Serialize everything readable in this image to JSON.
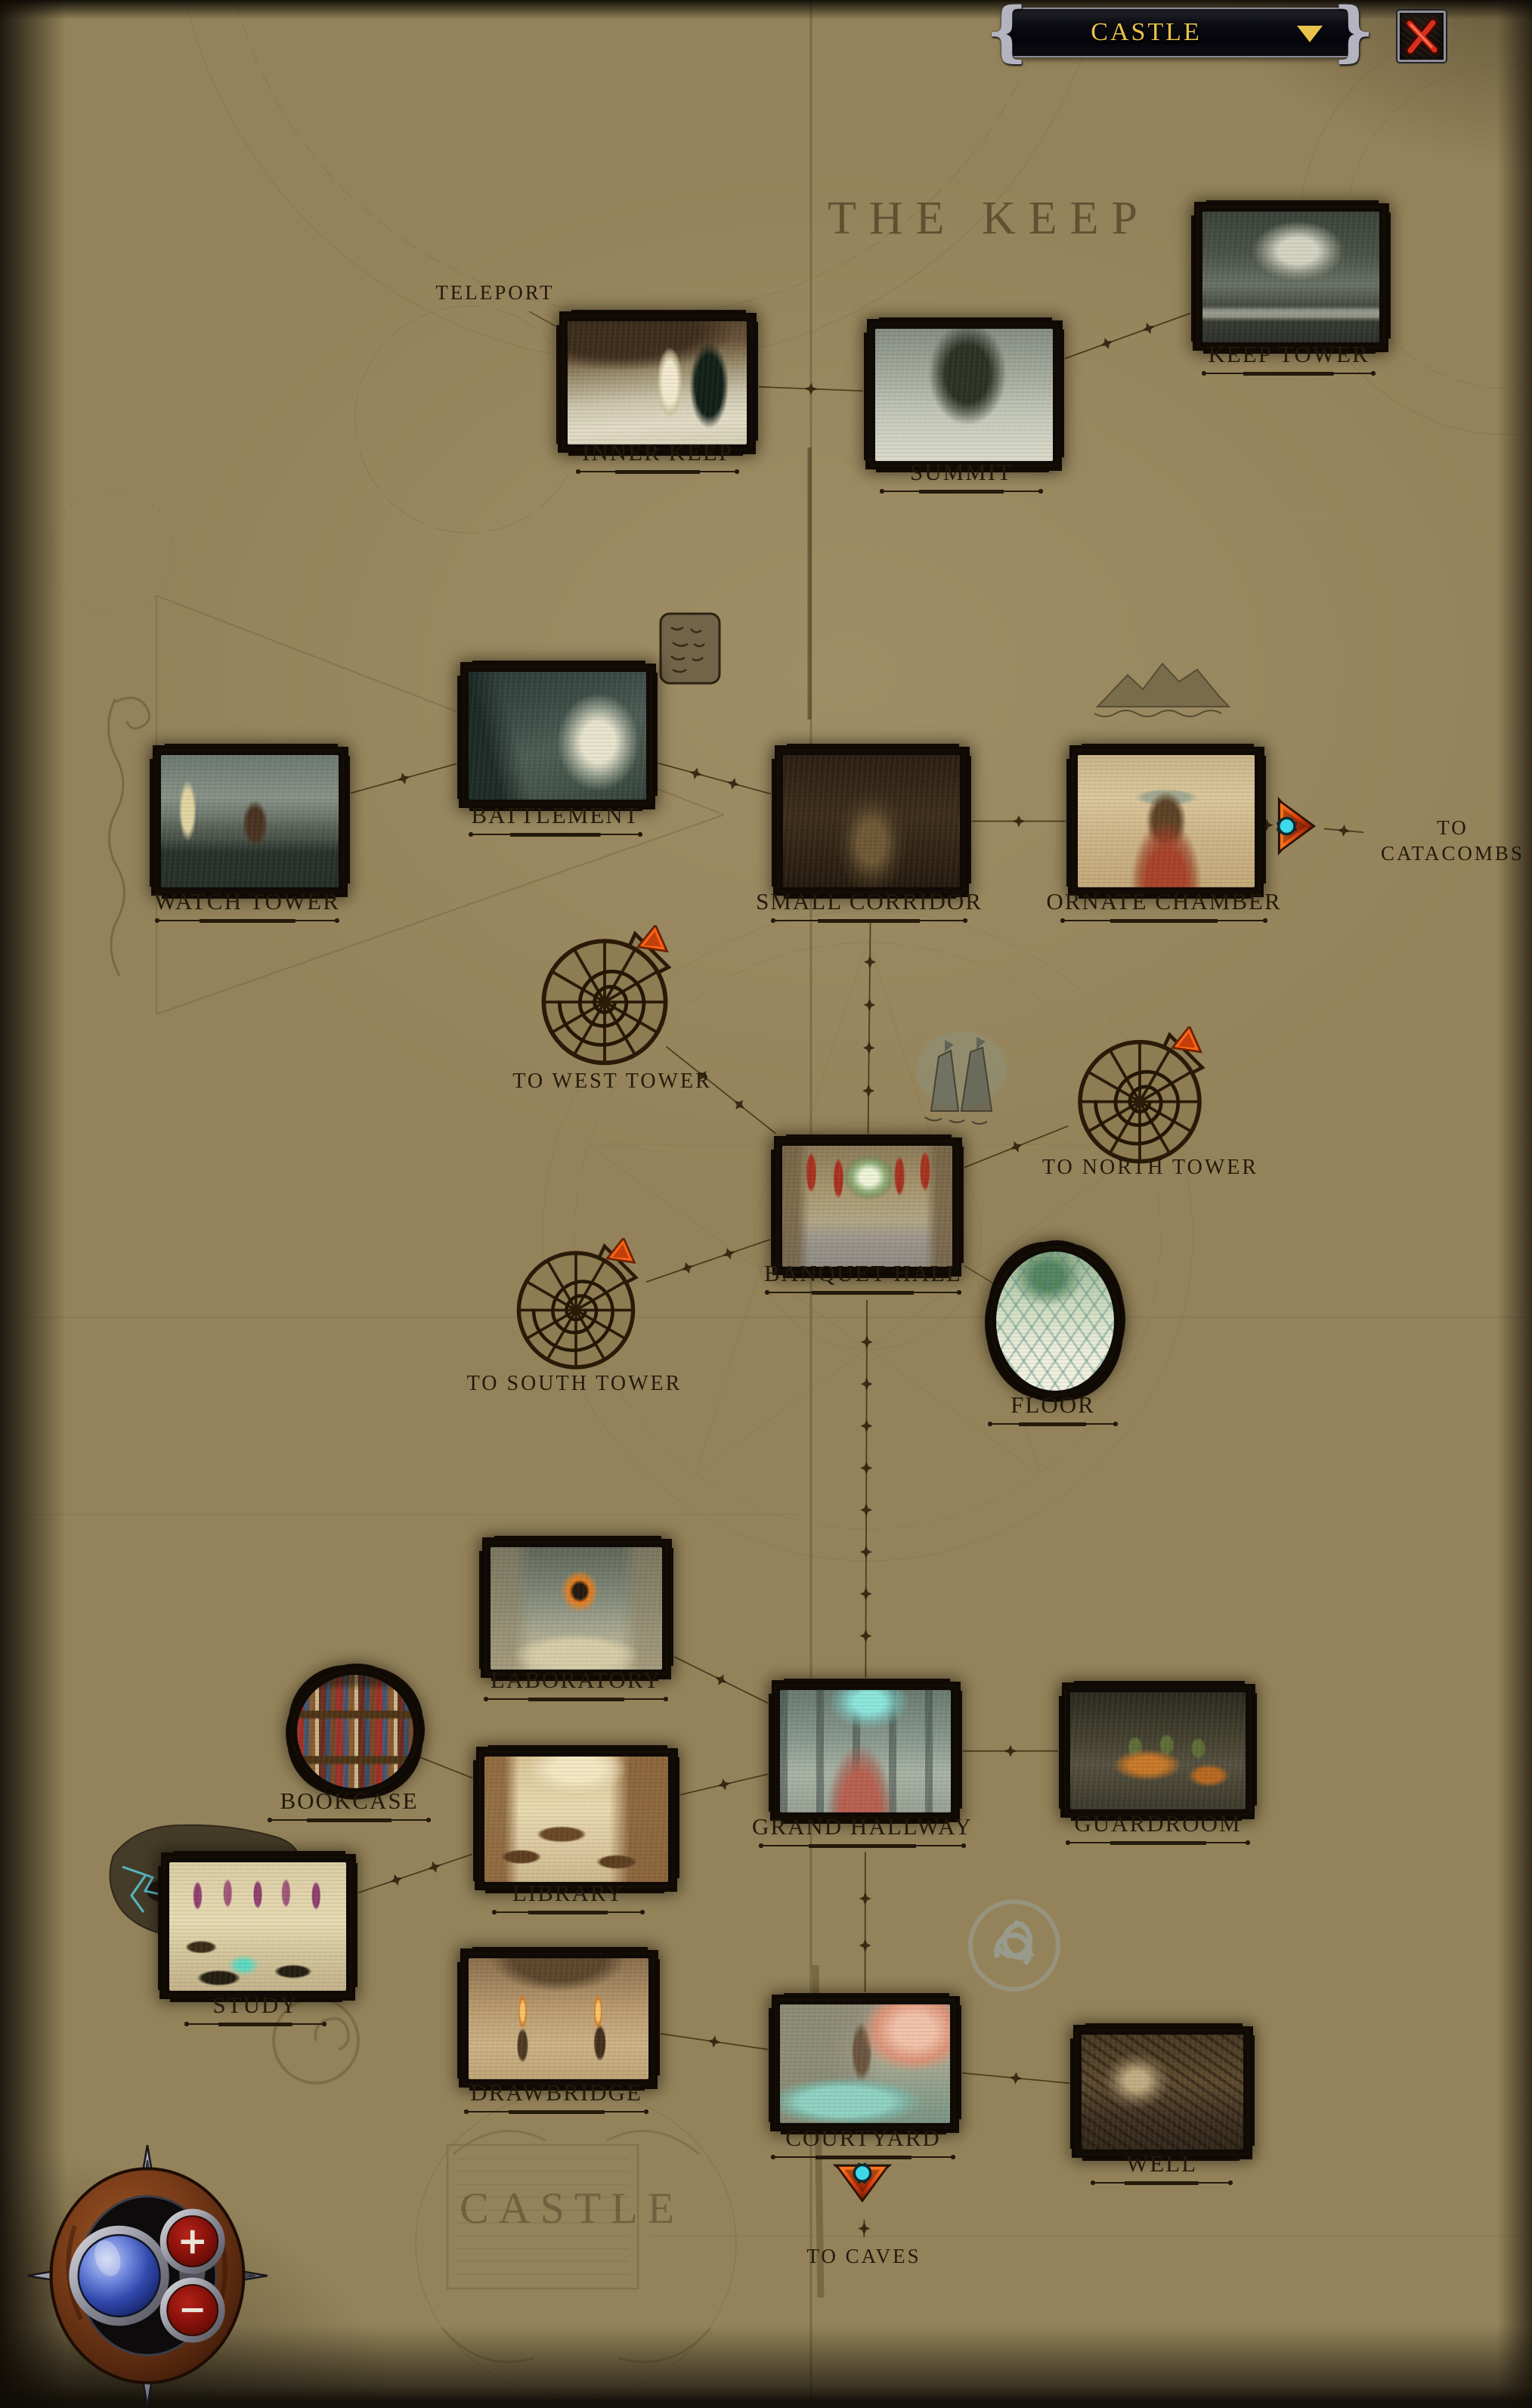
{
  "header": {
    "location_dropdown": {
      "value": "CASTLE",
      "caret_icon": "triangle-down-icon"
    },
    "close_icon": "red-x-icon"
  },
  "headings": {
    "keep": "THE KEEP",
    "castle": "CASTLE"
  },
  "annotations": {
    "teleport": "TELEPORT"
  },
  "nodes": {
    "inner_keep": {
      "label": "INNER KEEP"
    },
    "summit": {
      "label": "SUMMIT"
    },
    "keep_tower": {
      "label": "KEEP TOWER"
    },
    "battlement": {
      "label": "BATTLEMENT"
    },
    "watch_tower": {
      "label": "WATCH TOWER"
    },
    "small_corridor": {
      "label": "SMALL CORRIDOR"
    },
    "ornate_chamber": {
      "label": "ORNATE CHAMBER"
    },
    "banquet_hall": {
      "label": "BANQUET HALL"
    },
    "floor": {
      "label": "FLOOR"
    },
    "laboratory": {
      "label": "LABORATORY"
    },
    "bookcase": {
      "label": "BOOKCASE"
    },
    "library": {
      "label": "LIBRARY"
    },
    "grand_hallway": {
      "label": "GRAND HALLWAY"
    },
    "guardroom": {
      "label": "GUARDROOM"
    },
    "study": {
      "label": "STUDY"
    },
    "drawbridge": {
      "label": "DRAWBRIDGE"
    },
    "courtyard": {
      "label": "COURTYARD"
    },
    "well": {
      "label": "WELL"
    }
  },
  "exits": {
    "catacombs": {
      "label": "TO CATACOMBS",
      "icon": "orange-arrow-right"
    },
    "west_tower": {
      "label": "TO WEST TOWER",
      "icon": "spiral-stair"
    },
    "north_tower": {
      "label": "TO NORTH TOWER",
      "icon": "spiral-stair"
    },
    "south_tower": {
      "label": "TO SOUTH TOWER",
      "icon": "spiral-stair"
    },
    "caves": {
      "label": "TO CAVES",
      "icon": "orange-arrow-down"
    }
  },
  "compass": {
    "zoom_in": "+",
    "zoom_out": "−"
  },
  "colors": {
    "parchment": "#94835a",
    "ink": "#241a0c",
    "accent_gold": "#e8c24a",
    "exit_arrow_orange": "#ff6316",
    "exit_arrow_cyan": "#3fd8e8",
    "close_x_red": "#d8301c"
  },
  "connections": [
    {
      "from": "teleport_label",
      "to": "inner_keep",
      "style": "plain"
    },
    {
      "from": "inner_keep",
      "to": "summit",
      "style": "barbed"
    },
    {
      "from": "summit",
      "to": "keep_tower",
      "style": "barbed"
    },
    {
      "from": "watch_tower",
      "to": "battlement",
      "style": "barbed"
    },
    {
      "from": "battlement",
      "to": "small_corridor",
      "style": "barbed"
    },
    {
      "from": "small_corridor",
      "to": "ornate_chamber",
      "style": "barbed"
    },
    {
      "from": "ornate_chamber",
      "to": "catacombs_arrow",
      "style": "barbed",
      "pad1": 2,
      "pad2": 0
    },
    {
      "from": "catacombs_arrow",
      "to": "catacombs_label",
      "style": "barbed"
    },
    {
      "from": "small_corridor",
      "to": "banquet_hall",
      "style": "barbed",
      "pad1": 34
    },
    {
      "from": "west_tower_stair",
      "to": "banquet_hall",
      "style": "barbed"
    },
    {
      "from": "north_tower_stair",
      "to": "banquet_hall",
      "style": "barbed"
    },
    {
      "from": "south_tower_stair",
      "to": "banquet_hall",
      "style": "barbed"
    },
    {
      "from": "banquet_hall",
      "to": "floor",
      "style": "plain"
    },
    {
      "from": "banquet_hall",
      "to": "grand_hallway",
      "style": "barbed",
      "pad1": 36
    },
    {
      "from": "laboratory",
      "to": "grand_hallway",
      "style": "barbed"
    },
    {
      "from": "library",
      "to": "grand_hallway",
      "style": "barbed"
    },
    {
      "from": "bookcase",
      "to": "library",
      "style": "arrow"
    },
    {
      "from": "study",
      "to": "library",
      "style": "barbed"
    },
    {
      "from": "grand_hallway",
      "to": "guardroom",
      "style": "barbed"
    },
    {
      "from": "grand_hallway",
      "to": "courtyard",
      "style": "barbed",
      "pad1": 44
    },
    {
      "from": "drawbridge",
      "to": "courtyard",
      "style": "barbed"
    },
    {
      "from": "courtyard",
      "to": "well",
      "style": "barbed"
    },
    {
      "from": "courtyard",
      "to": "caves_arrow",
      "style": "plain",
      "pad1": 30,
      "pad2": 2
    },
    {
      "from": "caves_arrow",
      "to": "caves_label",
      "style": "barbed"
    }
  ]
}
